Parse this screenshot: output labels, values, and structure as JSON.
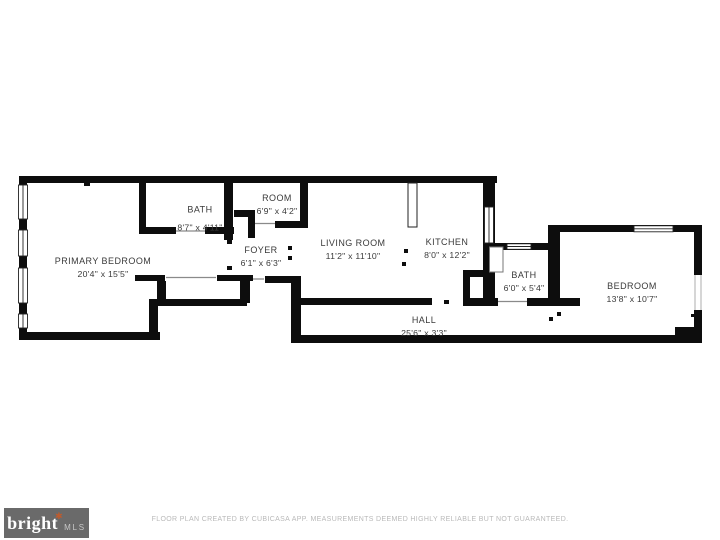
{
  "plan": {
    "rooms": [
      {
        "name": "PRIMARY BEDROOM",
        "dims": "20'4\" x 15'5\""
      },
      {
        "name": "BATH",
        "dims": "8'7\" x 4'11\""
      },
      {
        "name": "ROOM",
        "dims": "6'9\" x 4'2\""
      },
      {
        "name": "FOYER",
        "dims": "6'1\" x 6'3\""
      },
      {
        "name": "LIVING ROOM",
        "dims": "11'2\" x 11'10\""
      },
      {
        "name": "KITCHEN",
        "dims": "8'0\" x 12'2\""
      },
      {
        "name": "BATH",
        "dims": "6'0\" x 5'4\""
      },
      {
        "name": "BEDROOM",
        "dims": "13'8\" x 10'7\""
      },
      {
        "name": "HALL",
        "dims": "25'6\" x 3'3\""
      }
    ],
    "colors": {
      "wall": "#0d0d0d",
      "label": "#3a3a3a"
    }
  },
  "footer": {
    "logo": {
      "brand": "bright",
      "asterisk": "✱",
      "suffix": "MLS",
      "bg": "#6a6a6a",
      "asterisk_color": "#bf5b2d"
    },
    "disclaimer": "FLOOR PLAN CREATED BY CUBICASA APP. MEASUREMENTS DEEMED HIGHLY RELIABLE BUT NOT GUARANTEED."
  }
}
